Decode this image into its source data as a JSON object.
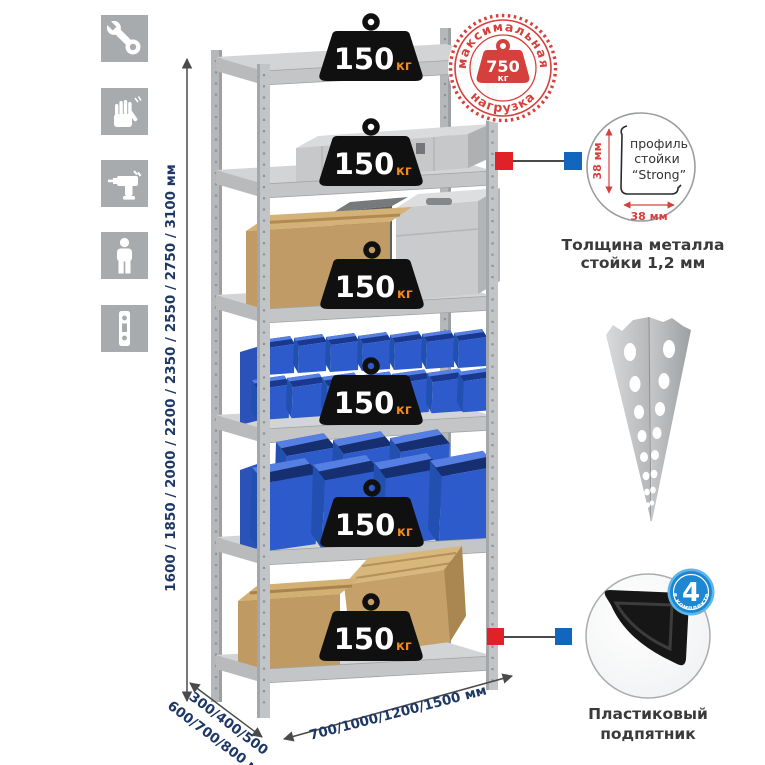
{
  "sidebar": {
    "icons": [
      {
        "name": "wrench-icon"
      },
      {
        "name": "gloves-icon"
      },
      {
        "name": "drill-icon"
      },
      {
        "name": "person-icon"
      },
      {
        "name": "rack-post-icon"
      }
    ]
  },
  "dimensions": {
    "height_label": "1600 / 1850 / 2000 / 2200 / 2350 / 2550 / 2750 / 3100 мм",
    "depth_label_line1": "300/400/500",
    "depth_label_line2": "600/700/800 мм",
    "width_label": "700/1000/1200/1500 мм"
  },
  "shelf_weights": {
    "value": "150",
    "unit": "кг",
    "count": 6
  },
  "max_load_stamp": {
    "top_text": "максимальная",
    "bottom_text": "нагрузка",
    "value": "750",
    "unit": "кг"
  },
  "profile_callout": {
    "label_line1": "профиль",
    "label_line2": "стойки",
    "label_line3": "“Strong”",
    "vertical_dim": "38 мм",
    "horizontal_dim": "38 мм",
    "caption_line1": "Толщина металла",
    "caption_line2": "стойки 1,2 мм"
  },
  "foot_callout": {
    "badge_number": "4",
    "badge_text": "в комплекте",
    "caption_line1": "Пластиковый",
    "caption_line2": "подпятник"
  },
  "colors": {
    "accent_red": "#d6403c",
    "marker_red": "#e02128",
    "marker_blue": "#1366bd",
    "dim_text_navy": "#1e3866",
    "weight_black": "#101010",
    "weight_unit_orange": "#f08a1d",
    "bin_blue": "#2e5bcb",
    "icon_tile_gray": "#a7abad"
  }
}
